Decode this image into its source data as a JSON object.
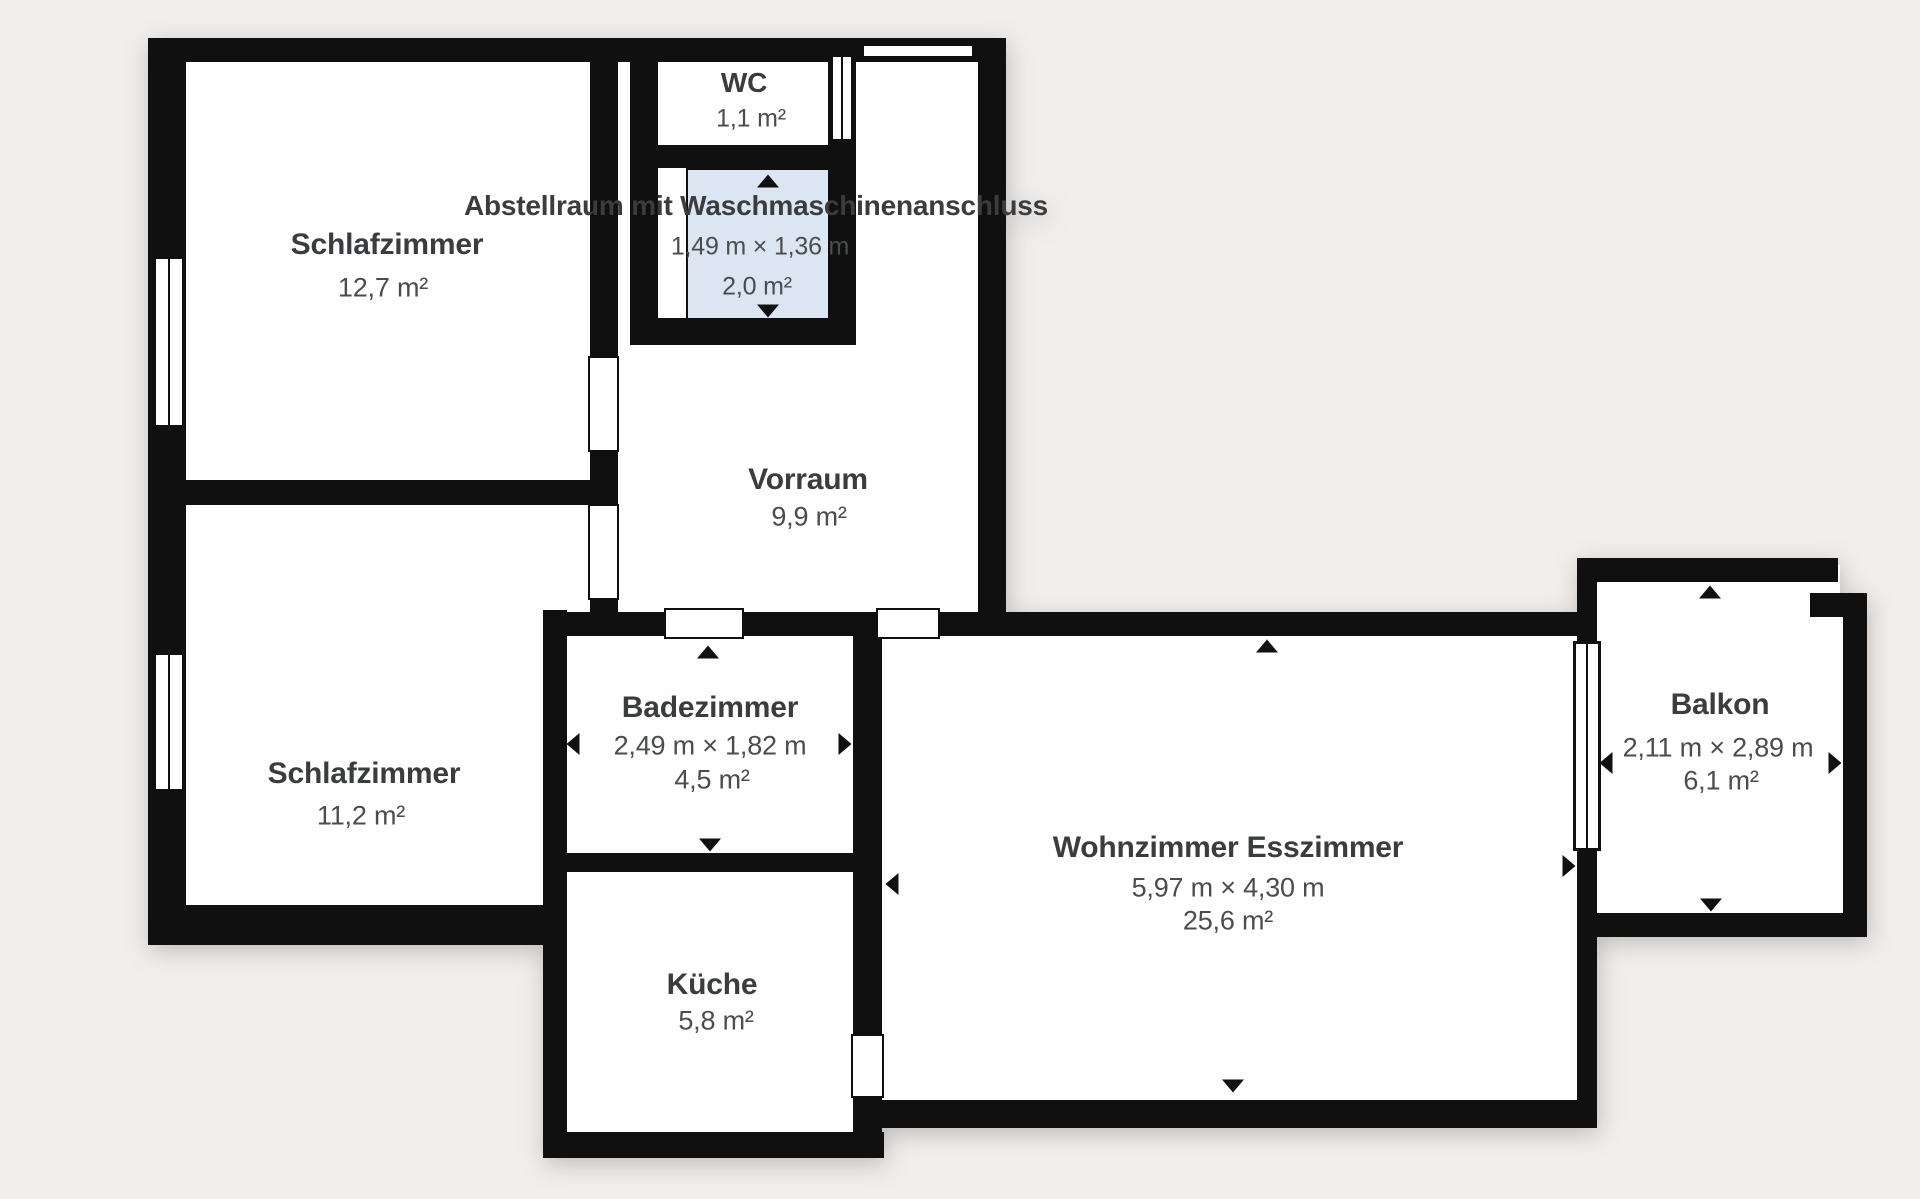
{
  "colors": {
    "background": "#f1efed",
    "wall": "#101010",
    "room_fill": "#fefefe",
    "highlight_fill": "#dce6f3",
    "text": "#3a3c3e"
  },
  "rooms": [
    {
      "id": "schlafzimmer-1",
      "name": "Schlafzimmer",
      "area": "12,7 m²"
    },
    {
      "id": "schlafzimmer-2",
      "name": "Schlafzimmer",
      "area": "11,2 m²"
    },
    {
      "id": "wc",
      "name": "WC",
      "area": "1,1 m²"
    },
    {
      "id": "abstellraum",
      "name": "Abstellraum mit Waschmaschinenanschluss",
      "dimensions": "1,49 m × 1,36 m",
      "area": "2,0 m²"
    },
    {
      "id": "vorraum",
      "name": "Vorraum",
      "area": "9,9 m²"
    },
    {
      "id": "badezimmer",
      "name": "Badezimmer",
      "dimensions": "2,49 m × 1,82 m",
      "area": "4,5 m²"
    },
    {
      "id": "kueche",
      "name": "Küche",
      "area": "5,8 m²"
    },
    {
      "id": "wohnzimmer",
      "name": "Wohnzimmer Esszimmer",
      "dimensions": "5,97 m × 4,30 m",
      "area": "25,6 m²"
    },
    {
      "id": "balkon",
      "name": "Balkon",
      "dimensions": "2,11 m × 2,89 m",
      "area": "6,1 m²"
    }
  ],
  "geometry": {
    "fills": [
      {
        "n": "room-fill-schlafzimmer-1",
        "x": 160,
        "y": 48,
        "w": 455,
        "h": 444
      },
      {
        "n": "room-fill-schlafzimmer-2a",
        "x": 160,
        "y": 490,
        "w": 455,
        "h": 132
      },
      {
        "n": "room-fill-schlafzimmer-2b",
        "x": 160,
        "y": 600,
        "w": 398,
        "h": 330
      },
      {
        "n": "room-fill-vorraum",
        "x": 600,
        "y": 45,
        "w": 395,
        "h": 585
      },
      {
        "n": "room-fill-wc-column",
        "x": 640,
        "y": 48,
        "w": 206,
        "h": 290
      },
      {
        "n": "room-fill-bad-kueche",
        "x": 550,
        "y": 615,
        "w": 325,
        "h": 535
      },
      {
        "n": "room-fill-wohnzimmer",
        "x": 865,
        "y": 615,
        "w": 725,
        "h": 505
      },
      {
        "n": "room-fill-balkon-a",
        "x": 1585,
        "y": 565,
        "w": 255,
        "h": 50
      },
      {
        "n": "room-fill-balkon-b",
        "x": 1585,
        "y": 600,
        "w": 272,
        "h": 327
      }
    ],
    "highlights": [
      {
        "n": "room-highlight-abstellraum",
        "x": 688,
        "y": 170,
        "w": 140,
        "h": 148
      }
    ],
    "walls": [
      {
        "n": "wall-exterior-left",
        "x": 148,
        "y": 38,
        "w": 38,
        "h": 907
      },
      {
        "n": "wall-exterior-top",
        "x": 148,
        "y": 38,
        "w": 858,
        "h": 24
      },
      {
        "n": "wall-vorraum-right",
        "x": 978,
        "y": 38,
        "w": 28,
        "h": 598
      },
      {
        "n": "wall-schlaf1-right-upper",
        "x": 590,
        "y": 38,
        "w": 28,
        "h": 326
      },
      {
        "n": "wall-schlaf1-right-lower",
        "x": 590,
        "y": 448,
        "w": 28,
        "h": 60
      },
      {
        "n": "wall-schlaf-divider",
        "x": 148,
        "y": 480,
        "w": 470,
        "h": 25
      },
      {
        "n": "wall-schlaf2-right-nub",
        "x": 590,
        "y": 596,
        "w": 28,
        "h": 40
      },
      {
        "n": "wall-wc-column-left",
        "x": 630,
        "y": 38,
        "w": 28,
        "h": 307
      },
      {
        "n": "wall-wc-column-right",
        "x": 828,
        "y": 38,
        "w": 28,
        "h": 307
      },
      {
        "n": "wall-wc-abstell-divider",
        "x": 630,
        "y": 145,
        "w": 226,
        "h": 25
      },
      {
        "n": "wall-abstell-bottom",
        "x": 630,
        "y": 318,
        "w": 226,
        "h": 27
      },
      {
        "n": "wall-bad-kueche-left",
        "x": 543,
        "y": 610,
        "w": 24,
        "h": 548
      },
      {
        "n": "wall-horizontal-main",
        "x": 543,
        "y": 612,
        "w": 1054,
        "h": 24
      },
      {
        "n": "wall-bad-kueche-right",
        "x": 853,
        "y": 612,
        "w": 29,
        "h": 523
      },
      {
        "n": "wall-bad-kueche-divider",
        "x": 543,
        "y": 853,
        "w": 339,
        "h": 19
      },
      {
        "n": "wall-kueche-bottom",
        "x": 543,
        "y": 1132,
        "w": 341,
        "h": 26
      },
      {
        "n": "wall-wohnzimmer-bottom",
        "x": 855,
        "y": 1100,
        "w": 742,
        "h": 28
      },
      {
        "n": "wall-wohnzimmer-right",
        "x": 1577,
        "y": 558,
        "w": 20,
        "h": 570
      },
      {
        "n": "wall-schlaf2-bottom",
        "x": 148,
        "y": 905,
        "w": 419,
        "h": 40
      },
      {
        "n": "wall-balkon-top",
        "x": 1577,
        "y": 558,
        "w": 261,
        "h": 24
      },
      {
        "n": "wall-balkon-right",
        "x": 1843,
        "y": 595,
        "w": 24,
        "h": 342
      },
      {
        "n": "wall-balkon-step",
        "x": 1810,
        "y": 593,
        "w": 57,
        "h": 24
      },
      {
        "n": "wall-balkon-bottom",
        "x": 1577,
        "y": 913,
        "w": 290,
        "h": 24
      }
    ],
    "doors": [
      {
        "n": "door-entry",
        "x": 862,
        "y": 44,
        "w": 112,
        "h": 14
      },
      {
        "n": "door-schlafzimmer-1",
        "x": 588,
        "y": 356,
        "w": 31,
        "h": 96
      },
      {
        "n": "door-schlafzimmer-2",
        "x": 588,
        "y": 504,
        "w": 31,
        "h": 96
      },
      {
        "n": "door-abstellraum",
        "x": 656,
        "y": 166,
        "w": 32,
        "h": 154
      },
      {
        "n": "door-badezimmer",
        "x": 664,
        "y": 608,
        "w": 80,
        "h": 31
      },
      {
        "n": "door-wohnzimmer",
        "x": 876,
        "y": 608,
        "w": 64,
        "h": 31
      },
      {
        "n": "door-kueche",
        "x": 851,
        "y": 1034,
        "w": 33,
        "h": 64
      }
    ],
    "windows": [
      {
        "n": "window-schlafzimmer-1",
        "x": 153,
        "y": 256,
        "w": 32,
        "h": 172
      },
      {
        "n": "window-schlafzimmer-2",
        "x": 153,
        "y": 652,
        "w": 32,
        "h": 140
      },
      {
        "n": "window-wc",
        "x": 830,
        "y": 54,
        "w": 24,
        "h": 88
      },
      {
        "n": "window-balkon-door",
        "x": 1573,
        "y": 641,
        "w": 28,
        "h": 210
      }
    ],
    "arrows": [
      {
        "n": "arrow-up-icon-badezimmer",
        "x": 708,
        "y": 652,
        "d": "up"
      },
      {
        "n": "arrow-down-icon-badezimmer",
        "x": 710,
        "y": 845,
        "d": "down"
      },
      {
        "n": "arrow-left-icon-badezimmer",
        "x": 573,
        "y": 744,
        "d": "left"
      },
      {
        "n": "arrow-right-icon-badezimmer",
        "x": 845,
        "y": 744,
        "d": "right"
      },
      {
        "n": "arrow-up-icon-wohnzimmer",
        "x": 1267,
        "y": 646,
        "d": "up"
      },
      {
        "n": "arrow-left-icon-wohnzimmer",
        "x": 892,
        "y": 884,
        "d": "left"
      },
      {
        "n": "arrow-right-icon-wohnzimmer",
        "x": 1569,
        "y": 866,
        "d": "right"
      },
      {
        "n": "arrow-down-icon-wohnzimmer",
        "x": 1233,
        "y": 1086,
        "d": "down"
      },
      {
        "n": "arrow-up-icon-balkon",
        "x": 1710,
        "y": 592,
        "d": "up"
      },
      {
        "n": "arrow-left-icon-balkon",
        "x": 1606,
        "y": 763,
        "d": "left"
      },
      {
        "n": "arrow-right-icon-balkon",
        "x": 1835,
        "y": 763,
        "d": "right"
      },
      {
        "n": "arrow-down-icon-balkon",
        "x": 1711,
        "y": 905,
        "d": "down"
      },
      {
        "n": "arrow-up-icon-abstellraum",
        "x": 768,
        "y": 181,
        "d": "up"
      },
      {
        "n": "arrow-down-icon-abstellraum",
        "x": 768,
        "y": 311,
        "d": "down"
      }
    ],
    "labels": [
      {
        "n": "label-schlafzimmer-1-name",
        "bind": "rooms.0.name",
        "x": 387,
        "y": 245,
        "cls": "room-name"
      },
      {
        "n": "label-schlafzimmer-1-area",
        "bind": "rooms.0.area",
        "x": 383,
        "y": 288,
        "cls": "room-sub"
      },
      {
        "n": "label-schlafzimmer-2-name",
        "bind": "rooms.1.name",
        "x": 364,
        "y": 774,
        "cls": "room-name"
      },
      {
        "n": "label-schlafzimmer-2-area",
        "bind": "rooms.1.area",
        "x": 361,
        "y": 816,
        "cls": "room-sub"
      },
      {
        "n": "label-wc-name",
        "bind": "rooms.2.name",
        "x": 744,
        "y": 83,
        "cls": "room-name-sm"
      },
      {
        "n": "label-wc-area",
        "bind": "rooms.2.area",
        "x": 751,
        "y": 119,
        "cls": "room-sub-sm"
      },
      {
        "n": "label-abstellraum-name",
        "bind": "rooms.3.name",
        "x": 756,
        "y": 206,
        "cls": "room-name-sm"
      },
      {
        "n": "label-abstellraum-dims",
        "bind": "rooms.3.dimensions",
        "x": 760,
        "y": 247,
        "cls": "room-sub-sm"
      },
      {
        "n": "label-abstellraum-area",
        "bind": "rooms.3.area",
        "x": 757,
        "y": 287,
        "cls": "room-sub-sm"
      },
      {
        "n": "label-vorraum-name",
        "bind": "rooms.4.name",
        "x": 808,
        "y": 480,
        "cls": "room-name"
      },
      {
        "n": "label-vorraum-area",
        "bind": "rooms.4.area",
        "x": 809,
        "y": 517,
        "cls": "room-sub"
      },
      {
        "n": "label-badezimmer-name",
        "bind": "rooms.5.name",
        "x": 710,
        "y": 708,
        "cls": "room-name"
      },
      {
        "n": "label-badezimmer-dims",
        "bind": "rooms.5.dimensions",
        "x": 710,
        "y": 746,
        "cls": "room-sub"
      },
      {
        "n": "label-badezimmer-area",
        "bind": "rooms.5.area",
        "x": 712,
        "y": 780,
        "cls": "room-sub"
      },
      {
        "n": "label-kueche-name",
        "bind": "rooms.6.name",
        "x": 712,
        "y": 985,
        "cls": "room-name"
      },
      {
        "n": "label-kueche-area",
        "bind": "rooms.6.area",
        "x": 716,
        "y": 1021,
        "cls": "room-sub"
      },
      {
        "n": "label-wohnzimmer-name",
        "bind": "rooms.7.name",
        "x": 1228,
        "y": 848,
        "cls": "room-name"
      },
      {
        "n": "label-wohnzimmer-dims",
        "bind": "rooms.7.dimensions",
        "x": 1228,
        "y": 888,
        "cls": "room-sub"
      },
      {
        "n": "label-wohnzimmer-area",
        "bind": "rooms.7.area",
        "x": 1228,
        "y": 921,
        "cls": "room-sub"
      },
      {
        "n": "label-balkon-name",
        "bind": "rooms.8.name",
        "x": 1720,
        "y": 705,
        "cls": "room-name"
      },
      {
        "n": "label-balkon-dims",
        "bind": "rooms.8.dimensions",
        "x": 1718,
        "y": 748,
        "cls": "room-sub"
      },
      {
        "n": "label-balkon-area",
        "bind": "rooms.8.area",
        "x": 1721,
        "y": 781,
        "cls": "room-sub"
      }
    ]
  }
}
